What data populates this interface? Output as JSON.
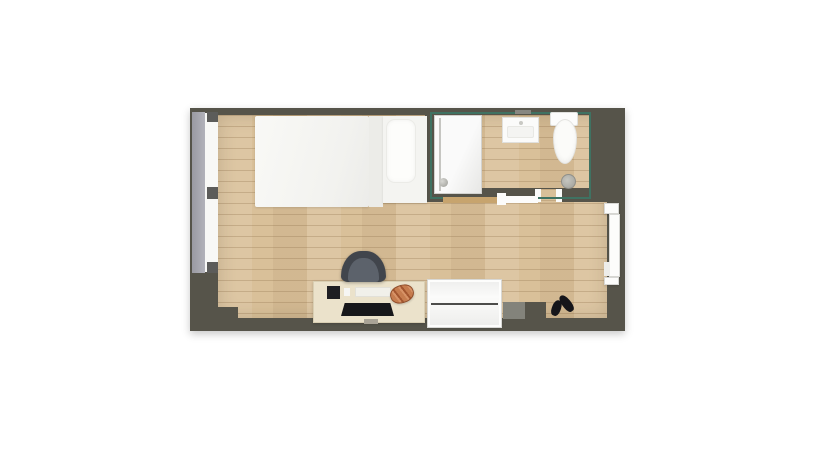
{
  "meta": {
    "view": "top-down-floor-plan",
    "canvas_width": 835,
    "canvas_height": 467
  },
  "colors": {
    "page_bg": "#ffffff",
    "wall": "#56544a",
    "wall_light": "#83837b",
    "floor": "#d9c099",
    "bath_lining": "#3f7262",
    "window_band": "#a4a4ac",
    "window_frame": "#5c5c5a",
    "fixture_white": "#fbfbf9",
    "desk": "#ebe2cb",
    "rail_wood": "#c7a46e",
    "chair": "#41454c",
    "croissant": "#c67c4e",
    "shoe": "#15151a",
    "cabinet": "#fafafa"
  },
  "plan": {
    "left": 190,
    "top": 108,
    "width": 435,
    "height": 223
  },
  "items": [
    {
      "name": "outer-wall",
      "type": "wallbase",
      "x": 190,
      "y": 108,
      "w": 435,
      "h": 223,
      "color": "wall",
      "interactable": false
    },
    {
      "name": "room-floor",
      "type": "floor",
      "x": 218,
      "y": 115,
      "w": 389,
      "h": 203,
      "interactable": false
    },
    {
      "name": "wall-step-left",
      "type": "rect",
      "x": 217,
      "y": 307,
      "w": 21,
      "h": 12,
      "color": "wall",
      "interactable": false
    },
    {
      "name": "wall-column",
      "type": "rect",
      "x": 503,
      "y": 302,
      "w": 23,
      "h": 17,
      "color": "wall_light",
      "interactable": false
    },
    {
      "name": "wall-step-right",
      "type": "rect",
      "x": 525,
      "y": 302,
      "w": 21,
      "h": 17,
      "color": "wall",
      "interactable": false
    },
    {
      "name": "bathroom-wall-left",
      "type": "rect",
      "x": 425,
      "y": 115,
      "w": 9,
      "h": 87,
      "color": "wall",
      "interactable": false
    },
    {
      "name": "bathroom-wall-right",
      "type": "rect",
      "x": 591,
      "y": 115,
      "w": 16,
      "h": 74,
      "color": "wall",
      "interactable": false
    },
    {
      "name": "bathroom-wall-bottom",
      "type": "rect",
      "x": 425,
      "y": 188,
      "w": 182,
      "h": 14,
      "color": "wall",
      "interactable": false
    },
    {
      "name": "bathroom-door-opening",
      "type": "floorpatch",
      "x": 539,
      "y": 189,
      "w": 18,
      "h": 13,
      "interactable": false
    },
    {
      "name": "bathroom-door-jamb-left",
      "type": "rect",
      "x": 535,
      "y": 189,
      "w": 6,
      "h": 13,
      "color": "#fbfbfa",
      "interactable": false
    },
    {
      "name": "bathroom-door-jamb-right",
      "type": "rect",
      "x": 556,
      "y": 189,
      "w": 6,
      "h": 13,
      "color": "#fbfbfa",
      "interactable": false
    },
    {
      "name": "bathroom-wall-lining",
      "type": "outline",
      "x": 430,
      "y": 112,
      "w": 161,
      "h": 87,
      "interactable": false
    },
    {
      "name": "shower",
      "type": "shower",
      "x": 434,
      "y": 115,
      "w": 48,
      "h": 79,
      "interactable": true
    },
    {
      "name": "sink-faucet",
      "type": "rect",
      "x": 515,
      "y": 110,
      "w": 16,
      "h": 4,
      "color": "#878781",
      "interactable": false
    },
    {
      "name": "sink",
      "type": "sink",
      "x": 502,
      "y": 117,
      "w": 37,
      "h": 26,
      "interactable": true
    },
    {
      "name": "toilet-tank",
      "type": "toilet-tank",
      "x": 550,
      "y": 112,
      "w": 28,
      "h": 14,
      "interactable": true
    },
    {
      "name": "toilet-bowl",
      "type": "toilet-bowl",
      "x": 553,
      "y": 119,
      "w": 24,
      "h": 45,
      "interactable": true
    },
    {
      "name": "floor-drain",
      "type": "drain",
      "x": 561,
      "y": 174,
      "w": 15,
      "h": 15,
      "interactable": true
    },
    {
      "name": "sliding-door-panel",
      "type": "rect",
      "x": 443,
      "y": 197,
      "w": 57,
      "h": 6,
      "color": "rail_wood",
      "interactable": true
    },
    {
      "name": "sliding-door-track",
      "type": "rect",
      "x": 499,
      "y": 196,
      "w": 39,
      "h": 7,
      "color": "#fcfcfb",
      "interactable": true
    },
    {
      "name": "sliding-door-bracket",
      "type": "rect",
      "x": 497,
      "y": 193,
      "w": 9,
      "h": 12,
      "color": "#fcfcfb",
      "interactable": true
    },
    {
      "name": "entry-door-jamb-top",
      "type": "door",
      "x": 604,
      "y": 203,
      "w": 15,
      "h": 11,
      "interactable": true
    },
    {
      "name": "entry-door-leaf",
      "type": "door",
      "x": 609,
      "y": 214,
      "w": 11,
      "h": 63,
      "interactable": true
    },
    {
      "name": "entry-door-handle",
      "type": "rect",
      "x": 604,
      "y": 262,
      "w": 6,
      "h": 14,
      "color": "#ededea",
      "interactable": true
    },
    {
      "name": "entry-door-jamb-bottom",
      "type": "door",
      "x": 604,
      "y": 277,
      "w": 15,
      "h": 8,
      "interactable": true
    },
    {
      "name": "window",
      "type": "window-band",
      "x": 192,
      "y": 112,
      "w": 13,
      "h": 161,
      "interactable": true
    },
    {
      "name": "window-glazing",
      "type": "rect",
      "x": 205,
      "y": 113,
      "w": 13,
      "h": 159,
      "color": "#f8f8f6",
      "interactable": false
    },
    {
      "name": "window-frame-top",
      "type": "rect",
      "x": 207,
      "y": 112,
      "w": 11,
      "h": 10,
      "color": "window_frame",
      "interactable": false
    },
    {
      "name": "window-frame-middle",
      "type": "rect",
      "x": 207,
      "y": 187,
      "w": 11,
      "h": 12,
      "color": "window_frame",
      "interactable": false
    },
    {
      "name": "window-frame-bottom",
      "type": "rect",
      "x": 207,
      "y": 262,
      "w": 11,
      "h": 11,
      "color": "window_frame",
      "interactable": false
    },
    {
      "name": "bed-duvet",
      "type": "duvet",
      "x": 255,
      "y": 116,
      "w": 114,
      "h": 91,
      "interactable": true
    },
    {
      "name": "bed-duvet-fold",
      "type": "rect",
      "x": 369,
      "y": 116,
      "w": 14,
      "h": 91,
      "color": "#ecece8",
      "interactable": true
    },
    {
      "name": "bed-mattress",
      "type": "mattress",
      "x": 383,
      "y": 116,
      "w": 44,
      "h": 87,
      "interactable": true
    },
    {
      "name": "bed-pillow",
      "type": "pillow",
      "x": 386,
      "y": 119,
      "w": 30,
      "h": 64,
      "interactable": true
    },
    {
      "name": "desk",
      "type": "desk",
      "x": 313,
      "y": 281,
      "w": 112,
      "h": 42,
      "interactable": true
    },
    {
      "name": "desk-chair",
      "type": "chair",
      "x": 341,
      "y": 251,
      "w": 45,
      "h": 31,
      "interactable": true
    },
    {
      "name": "tablet",
      "type": "rect",
      "x": 327,
      "y": 286,
      "w": 13,
      "h": 13,
      "color": "#1e1e22",
      "interactable": true
    },
    {
      "name": "desk-small-item",
      "type": "rect",
      "x": 344,
      "y": 288,
      "w": 6,
      "h": 8,
      "color": "#f6f6f4",
      "interactable": true
    },
    {
      "name": "desk-paper",
      "type": "paper",
      "x": 355,
      "y": 287,
      "w": 36,
      "h": 10,
      "interactable": true
    },
    {
      "name": "keyboard",
      "type": "keyboard",
      "x": 341,
      "y": 303,
      "w": 53,
      "h": 13,
      "interactable": true
    },
    {
      "name": "desk-cable-tray",
      "type": "rect",
      "x": 364,
      "y": 319,
      "w": 14,
      "h": 5,
      "color": "#a9a396",
      "interactable": false
    },
    {
      "name": "croissant",
      "type": "croissant",
      "x": 390,
      "y": 285,
      "w": 24,
      "h": 18,
      "rotate": -18,
      "interactable": true
    },
    {
      "name": "cabinet",
      "type": "cabinet",
      "x": 428,
      "y": 280,
      "w": 73,
      "h": 47,
      "interactable": true
    },
    {
      "name": "shoe-left",
      "type": "shoe",
      "x": 552,
      "y": 300,
      "w": 9,
      "h": 16,
      "rotate": 20,
      "interactable": true
    },
    {
      "name": "shoe-right",
      "type": "shoe",
      "x": 562,
      "y": 294,
      "w": 9,
      "h": 19,
      "rotate": -38,
      "interactable": true
    }
  ]
}
